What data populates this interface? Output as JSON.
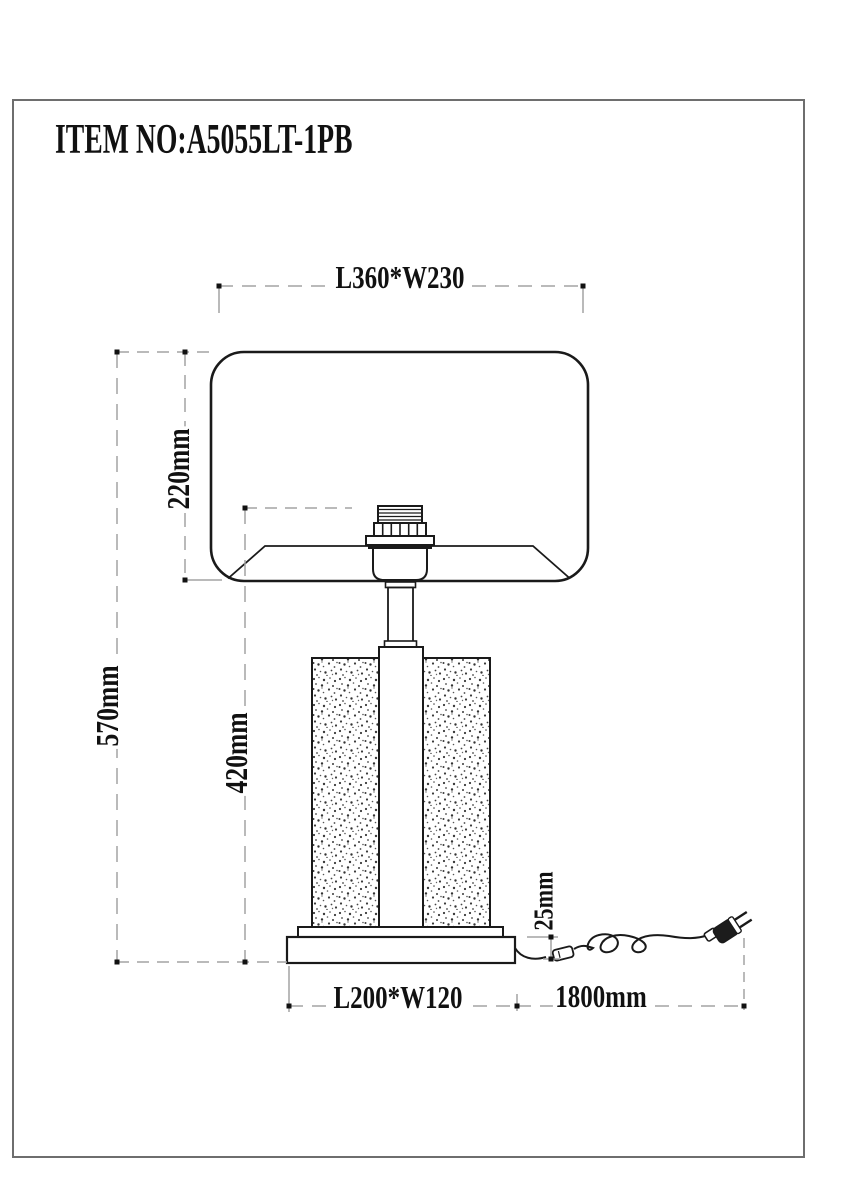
{
  "page": {
    "item_number": "ITEM NO:A5055LT-1PB"
  },
  "dims": {
    "shade_size": "L360*W230",
    "shade_height": "220mm",
    "total_height": "570mm",
    "body_height": "420mm",
    "base_size": "L200*W120",
    "cord_length": "1800mm",
    "base_thickness": "25mm"
  },
  "colors": {
    "outline": "#1a1a1a",
    "dimension_line": "#a3a3a3",
    "frame": "#6e6e6e",
    "background": "#ffffff"
  }
}
